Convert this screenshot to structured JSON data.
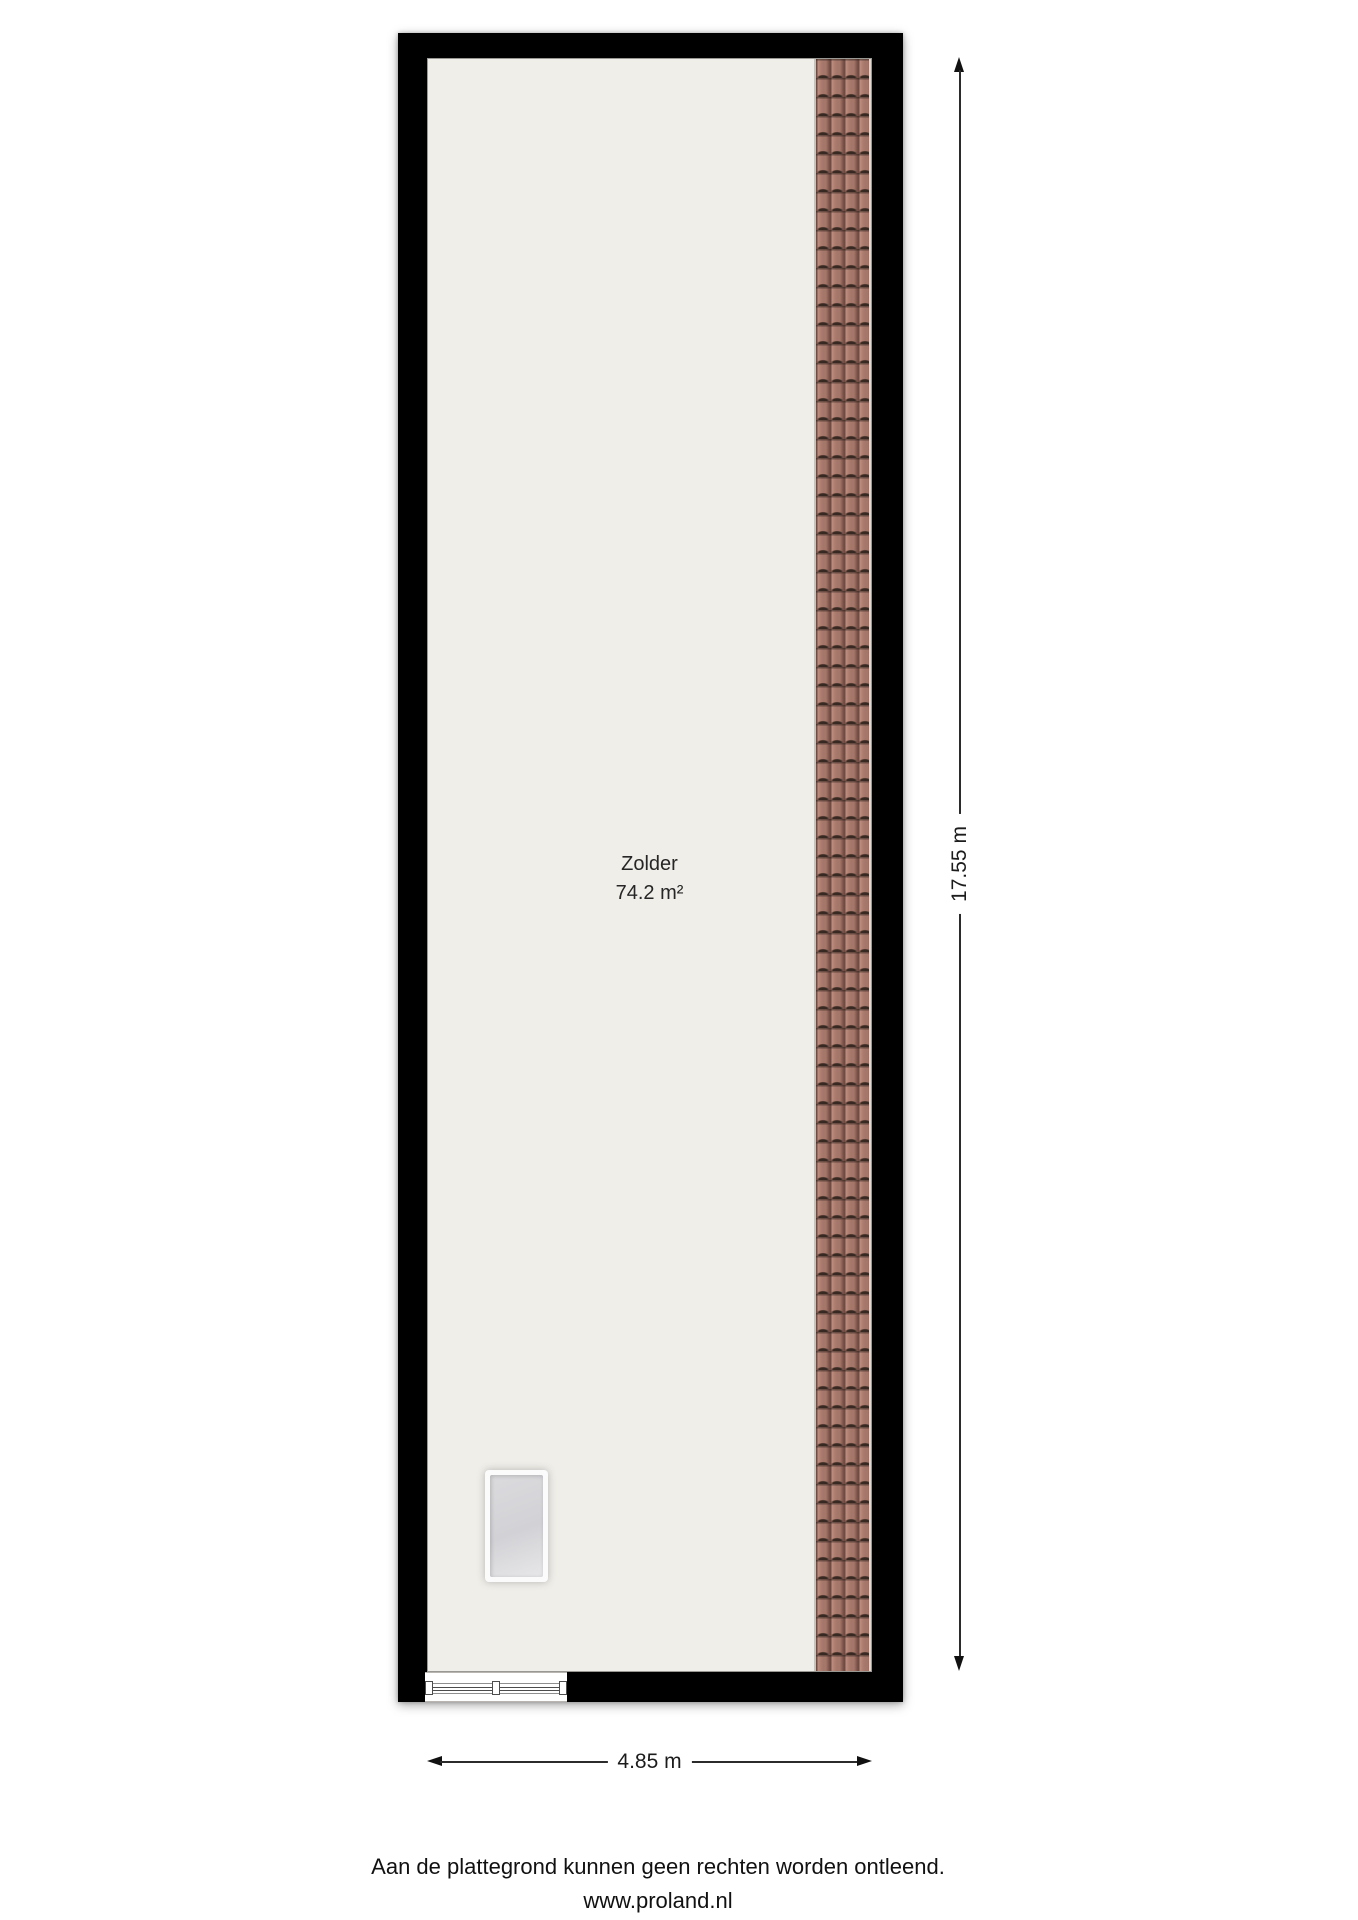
{
  "floorplan": {
    "room": {
      "name": "Zolder",
      "area": "74.2 m²"
    },
    "dimensions": {
      "vertical": "17.55 m",
      "horizontal": "4.85 m"
    },
    "colors": {
      "wall": "#000000",
      "floor": "#f0eee9",
      "roof_tile": "#a5766a",
      "dimension_line": "#2b2b2b",
      "page_background": "#ffffff"
    }
  },
  "footer": {
    "disclaimer": "Aan de plattegrond kunnen geen rechten worden ontleend.",
    "website": "www.proland.nl"
  }
}
